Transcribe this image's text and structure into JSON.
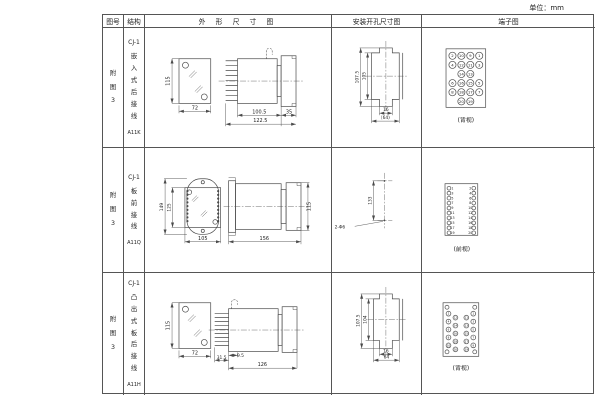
{
  "unit_note": "单位：mm",
  "table": {
    "headers": {
      "fig": "图号",
      "structure": "结构",
      "outline": "外 形 尺 寸 图",
      "mounting": "安装开孔尺寸图",
      "terminal": "端子图"
    }
  },
  "rows": [
    {
      "fig_no": "附图3",
      "model": "CJ-1",
      "structure": "嵌入式后接线",
      "code": "A11K",
      "outline_dims": {
        "front_h": "115",
        "front_w": "72",
        "body_d": "100.5",
        "total_d": "122.5",
        "flange_d": "35"
      },
      "mounting_dims": {
        "outer_h": "107.5",
        "inner_h": "105",
        "tab_w": "16",
        "span_w": "(64)"
      },
      "terminal": {
        "caption": "(背视)",
        "layout": "grid",
        "grid": [
          [
            "2",
            "10",
            "9",
            "1"
          ],
          [
            "4",
            "12",
            "11",
            "3"
          ],
          [
            "",
            "14",
            "13",
            ""
          ],
          [
            "6",
            "16",
            "15",
            "5"
          ],
          [
            "8",
            "18",
            "17",
            "7"
          ],
          [
            "",
            "20",
            "19",
            ""
          ]
        ]
      }
    },
    {
      "fig_no": "附图3",
      "model": "CJ-1",
      "structure": "板前接线",
      "code": "A11Q",
      "outline_dims": {
        "plate_h": "149",
        "inner_h": "125",
        "front_w": "105",
        "side_d": "156",
        "side_h": "115"
      },
      "mounting_dims": {
        "hole_pitch": "133",
        "holes": "2-Φ6"
      },
      "terminal": {
        "caption": "(前视)",
        "layout": "twocol",
        "left": [
          "1",
          "3",
          "5",
          "7",
          "9",
          "11",
          "13",
          "15",
          "17",
          "19"
        ],
        "right": [
          "2",
          "4",
          "6",
          "8",
          "10",
          "12",
          "14",
          "16",
          "18",
          "20"
        ]
      }
    },
    {
      "fig_no": "附图3",
      "model": "CJ-1",
      "structure": "凸出式板后接线",
      "code": "A11H",
      "outline_dims": {
        "front_h": "115",
        "front_w": "72",
        "pin_d": "31.5",
        "offset_d": "9.5",
        "body_d": "126"
      },
      "mounting_dims": {
        "outer_h": "107.5",
        "inner_h": "104",
        "tab_w": "16",
        "span_w": "64"
      },
      "terminal": {
        "caption": "(背视)",
        "layout": "staggered",
        "left_outer": [
          "2",
          "4",
          "6",
          "8",
          "10"
        ],
        "left_inner": [
          "12",
          "14",
          "16",
          "18",
          "20"
        ],
        "right_inner": [
          "11",
          "13",
          "15",
          "17",
          "19"
        ],
        "right_outer": [
          "1",
          "3",
          "5",
          "7",
          "9"
        ]
      }
    }
  ]
}
